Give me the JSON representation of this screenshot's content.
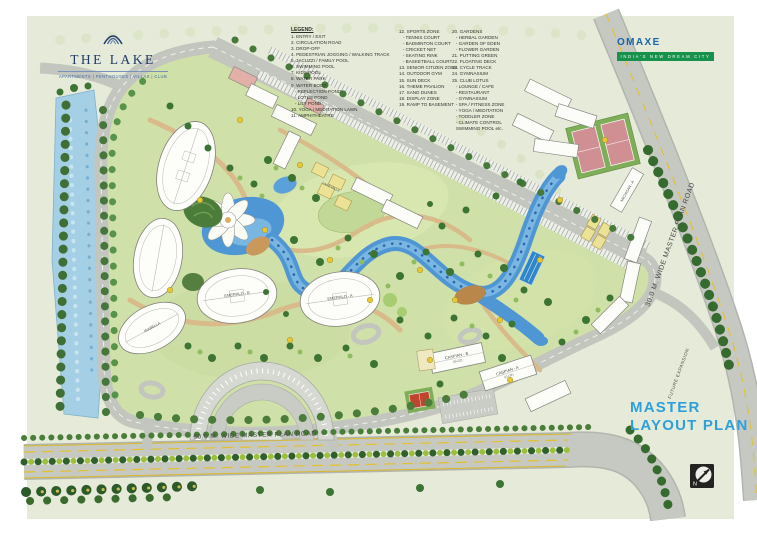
{
  "branding": {
    "project_name": "THE LAKE",
    "project_tagline": "APARTMENTS | PENTHOUSES | VILLAS | CLUB",
    "developer_name": "OMAXE",
    "developer_tagline": "INDIA'S NEW DREAM CITY"
  },
  "legend": {
    "heading": "LEGEND:",
    "column1": [
      "1. ENTRY / EXIT",
      "2. CIRCULATION ROAD",
      "3. DROP-OFF",
      "4. PEDESTRIAN JOGGING / WALKING TRACK",
      "5. JACUZZI / FAMILY POOL",
      "6. SWIMMING POOL",
      "7. KIDS POOL",
      "8. WATER PARK",
      "9. WATER BODY",
      "   - REFLECTION POND",
      "   - LOTUS POND",
      "   - LILY POND",
      "10. YOGA / MEDITATION LAWN",
      "11. AMPHITHEATRE"
    ],
    "column2": [
      "12. SPORTS ZONE",
      "   - TENNIS COURT",
      "   - BADMINTON COURT",
      "   - CRICKET NET",
      "   - SKATING RINK",
      "   - BASKETBALL COURT",
      "13. SENIOR CITIZEN ZONE",
      "14. OUTDOOR GYM",
      "15. SUN DECK",
      "16. THEME PAVILION",
      "17. SAND DUNES",
      "18. DISPLAY ZONE",
      "19. RAMP TO BASEMENT"
    ],
    "column3": [
      "20. GARDENS",
      "   - HERBAL GARDEN",
      "   - GARDEN OF EDEN",
      "   - FLOWER GARDEN",
      "21. PUTTING GREEN",
      "22. FLOATING DECK",
      "23. CYCLE TRACK",
      "24. GYMNASIUM",
      "25. CLUB LOTUS",
      "   - LOUNGE / CAFE",
      "   - RESTAURANT",
      "   - GYMNASIUM",
      "   - SPA / FITNESS ZONE",
      "   - YOGA / MEDITATION",
      "   - TODDLER ZONE",
      "   - CLIMATE CONTROL",
      "   SWIMMING POOL etc."
    ]
  },
  "plan": {
    "title": "MASTER\nLAYOUT PLAN",
    "north_label": "N",
    "road_right": "30.0 M. WIDE MASTER PLAN ROAD",
    "road_bottom": "60.0 M. WIDE MASTER PLAN ROAD",
    "future_expansion": "FUTURE EXPANSION",
    "buildings": {
      "caspian_a": "CASPIAN - A",
      "caspian_a_floors": "(G+22)",
      "caspian_b": "CASPIAN - B",
      "caspian_b_floors": "(G+22)",
      "emerald_a": "EMERALD - A",
      "emerald_b": "EMERALD - B",
      "isabella": "ISABELLA",
      "michigan": "MICHIGAN - A",
      "lake_villa": "LAKE VILLA"
    }
  },
  "colors": {
    "accent_blue": "#2da0dc",
    "brand_navy": "#203a68",
    "omaxe_green": "#17924c",
    "water_blue": "#4e96d4",
    "lawn_green": "#cfe0a8",
    "road_grey": "#c6c9c2"
  }
}
